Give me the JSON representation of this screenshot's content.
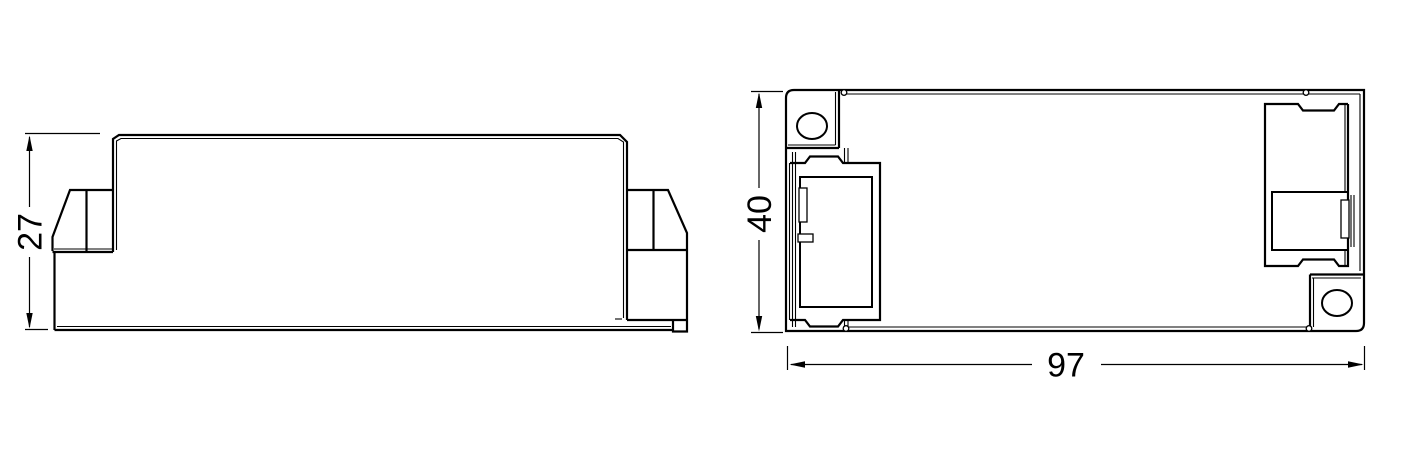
{
  "canvas": {
    "width": 1418,
    "height": 449,
    "background": "#ffffff",
    "line_color": "#000000"
  },
  "drawing": {
    "type": "technical-dimension-drawing",
    "subject": "enclosure-two-views",
    "side_view": {
      "dimensions": {
        "height": {
          "value": "27"
        }
      }
    },
    "top_view": {
      "dimensions": {
        "height": {
          "value": "40"
        },
        "width": {
          "value": "97"
        }
      }
    }
  }
}
